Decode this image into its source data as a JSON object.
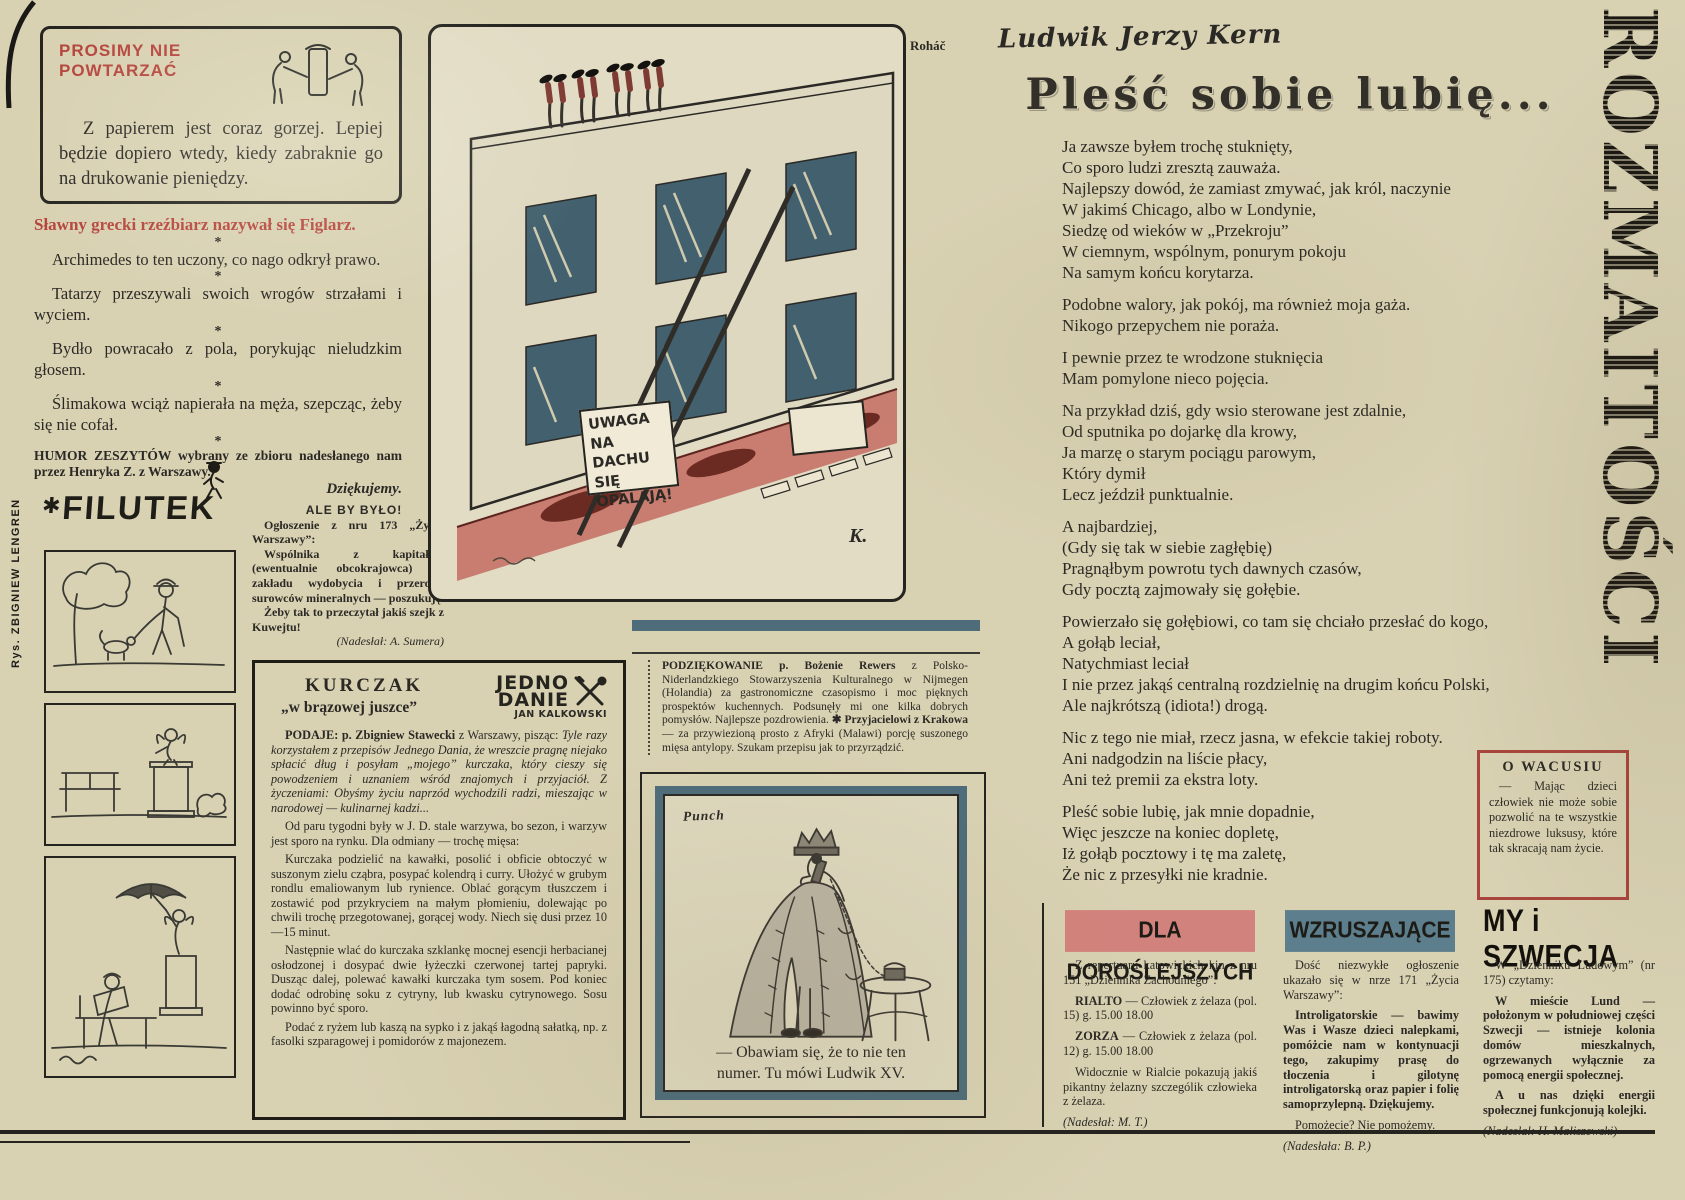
{
  "colors": {
    "paper": "#d8d1b2",
    "ink": "#2b2925",
    "accent_red": "#b5453c",
    "slate_blue": "#4e6c7a",
    "pink_label": "#d2827c",
    "road_pink": "#c87d70"
  },
  "page": {
    "masthead_vertical": "ROZMAITOŚCI",
    "artist_credit_vertical": "Rys. ZBIGNIEW LENGREN"
  },
  "no_repeat": {
    "title": "PROSIMY NIE\nPOWTARZAĆ",
    "body": "Z papierem jest coraz gorzej. Lepiej będzie dopiero wtedy, kiedy zabraknie go na drukowanie pieniędzy."
  },
  "humor": {
    "lead": "Sławny grecki rzeźbiarz nazywał się Figlarz.",
    "separator": "*",
    "items": [
      "Archimedes to ten uczony, co nago odkrył prawo.",
      "Tatarzy przeszywali swoich wrogów strzałami i wyciem.",
      "Bydło powracało z pola, porykując nieludzkim głosem.",
      "Ślimakowa wciąż napierała na męża, szepcząc, żeby się nie cofał."
    ],
    "credit": "HUMOR ZESZYTÓW wybrany ze zbioru nadesłanego nam przez Henryka Z. z Warszawy.",
    "thanks": "Dziękujemy."
  },
  "filutek": {
    "star": "✱",
    "name": "FILUTEK"
  },
  "ale": {
    "title": "ALE BY BYŁO!",
    "intro": "Ogłoszenie z nru 173 „Życia Warszawy”:",
    "ad": "Wspólnika z kapitałem (ewentualnie obcokrajowca) do zakładu wydobycia i przerobu surowców mineralnych — poszukuję.",
    "comment": "Żeby tak to przeczytał jakiś szejk z Kuwejtu!",
    "credit": "(Nadesłał: A. Sumera)"
  },
  "roof": {
    "artist": "Roháč",
    "sign": "UWAGA NA\nDACHU SIĘ\nOPALAJĄ!",
    "signature": "K."
  },
  "thanks_note": {
    "b1": "PODZIĘKOWANIE p. Bożenie Rewers",
    "t1": " z Polsko-Niderlandzkiego Stowarzyszenia Kulturalnego w Nijmegen (Holandia) za gastronomiczne czasopismo i moc pięknych prospektów kuchennych. Podsunęły mi one kilka dobrych pomysłów. Najlepsze pozdrowienia. ",
    "b2": "✱ Przyjacielowi z Krakowa",
    "t2": " — za przywiezioną prosto z Afryki (Malawi) porcję suszonego mięsa antylopy. Szukam przepisu jak to przyrządzić."
  },
  "kurczak": {
    "title": "KURCZAK",
    "subtitle": "„w brązowej juszce”",
    "logo_top": "JEDNO",
    "logo_bottom": "DANIE",
    "logo_author": "JAN KALKOWSKI",
    "lead_bold": "PODAJE: p. Zbigniew Stawecki",
    "lead_mid": " z Warszawy, pisząc: ",
    "lead_quote": "Tyle razy korzystałem z przepisów Jednego Dania, że wreszcie pragnę niejako spłacić dług i posyłam „mojego” kurczaka, który cieszy się powodzeniem i uznaniem wśród znajomych i przyjaciół. Z życzeniami: Obyśmy życiu naprzód wychodzili radzi, mieszając w narodowej — kulinarnej kadzi...",
    "p2": "Od paru tygodni były w J. D. stale warzywa, bo sezon, i warzyw jest sporo na rynku. Dla odmiany — trochę mięsa:",
    "p3": "Kurczaka podzielić na kawałki, posolić i obficie obtoczyć w suszonym zielu cząbra, posypać kolendrą i curry. Ułożyć w grubym rondlu emaliowanym lub rynience. Oblać gorącym tłuszczem i zostawić pod przykryciem na małym płomieniu, dolewając po chwili trochę przegotowanej, gorącej wody. Niech się dusi przez 10—15 minut.",
    "p4": "Następnie wlać do kurczaka szklankę mocnej esencji herbacianej osłodzonej i dosypać dwie łyżeczki czerwonej tartej papryki. Dusząc dalej, polewać kawałki kurczaka tym sosem. Pod koniec dodać odrobinę soku z cytryny, lub kwasku cytrynowego. Sosu powinno być sporo.",
    "p5": "Podać z ryżem lub kaszą na sypko i z jakąś łagodną sałatką, np. z fasolki szparagowej i pomidorów z majonezem."
  },
  "punch": {
    "label": "Punch",
    "caption": "— Obawiam się, że to nie ten\nnumer. Tu mówi Ludwik XV."
  },
  "poem": {
    "author": "Ludwik Jerzy Kern",
    "title": "Pleść sobie lubię...",
    "stanzas": [
      "Ja zawsze byłem trochę stuknięty,\nCo sporo ludzi zresztą zauważa.\nNajlepszy dowód, że zamiast zmywać, jak król, naczynie\nW jakimś Chicago, albo w Londynie,\nSiedzę od wieków w „Przekroju”\nW ciemnym, wspólnym, ponurym pokoju\nNa samym końcu korytarza.",
      "Podobne walory, jak pokój, ma również moja gaża.\nNikogo przepychem nie poraża.",
      "I pewnie przez te wrodzone stuknięcia\nMam pomylone nieco pojęcia.",
      "Na przykład dziś, gdy wsio sterowane jest zdalnie,\nOd sputnika po dojarkę dla krowy,\nJa marzę o starym pociągu parowym,\nKtóry dymił\nLecz jeździł punktualnie.",
      "A najbardziej,\n(Gdy się tak w siebie zagłębię)\nPragnąłbym powrotu tych dawnych czasów,\nGdy pocztą zajmowały się gołębie.",
      "Powierzało się gołębiowi, co tam się chciało przesłać do kogo,\nA gołąb leciał,\nNatychmiast leciał\nI nie przez jakąś centralną rozdzielnię na drugim końcu Polski,\nAle najkrótszą (idiota!) drogą.",
      "Nic z tego nie miał, rzecz jasna, w efekcie takiej roboty.\nAni nadgodzin na liście płacy,\nAni też premii za ekstra loty.",
      "Pleść sobie lubię, jak mnie dopadnie,\nWięc jeszcze na koniec dopletę,\nIż gołąb pocztowy i tę ma zaletę,\nŻe nic z przesyłki nie kradnie."
    ]
  },
  "wacusiu": {
    "title": "O WACUSIU",
    "body": "— Mając dzieci człowiek nie może sobie pozwolić na te wszystkie niezdrowe luksusy, które tak skracają nam życie."
  },
  "adult": {
    "title": "DLA DOROŚLEJSZYCH",
    "intro": "Z repertuaru katowickich kin z nru 151 „Dziennika Zachodniego”:",
    "c1name": "RIALTO",
    "c1rest": " — Człowiek z żelaza (pol. 15) g. 15.00 18.00",
    "c2name": "ZORZA",
    "c2rest": " — Człowiek z żelaza (pol. 12) g. 15.00 18.00",
    "comment": "Widocznie w Rialcie pokazują jakiś pikantny żelazny szczególik człowieka z żelaza.",
    "credit": "(Nadesłał: M. T.)"
  },
  "moving": {
    "title": "WZRUSZAJĄCE",
    "intro": "Dość niezwykłe ogłoszenie ukazało się w nrze 171 „Życia Warszawy”:",
    "body": "Introligatorskie — bawimy Was i Wasze dzieci nalepkami, pomóżcie nam w kontynuacji tego, zakupimy prasę do tłoczenia i gilotynę introligatorską oraz papier i folię samoprzylepną. Dziękujemy.",
    "punchline": "Pomożecie? Nie pomożemy.",
    "credit": "(Nadesłała: B. P.)"
  },
  "sweden": {
    "title": "MY i SZWECJA",
    "intro": "W „Dzienniku Ludowym” (nr 175) czytamy:",
    "body": "W mieście Lund — położonym w południowej części Szwecji — istnieje kolonia domów mieszkalnych, ogrzewanych wyłącznie za pomocą energii społecznej.",
    "punchline": "A u nas dzięki energii społecznej funkcjonują kolejki.",
    "credit": "(Nadesłał: H. Maliszewski)"
  }
}
